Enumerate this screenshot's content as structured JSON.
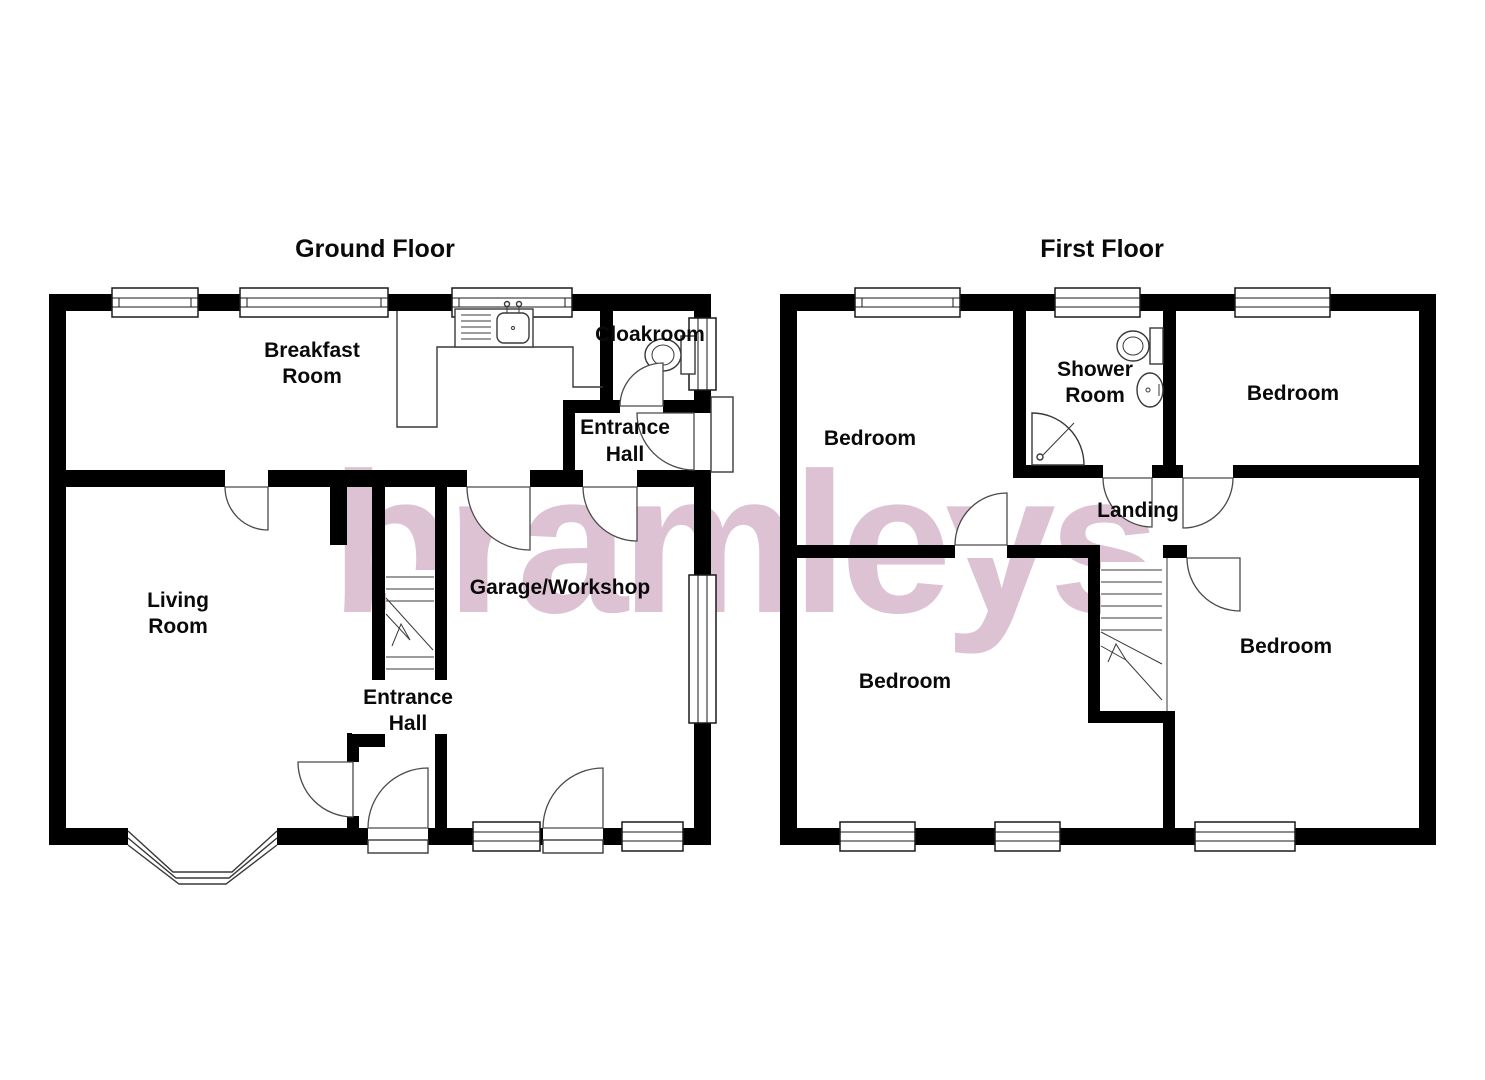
{
  "watermark": {
    "text": "bramleys",
    "color": "#ddc2d3"
  },
  "titles": {
    "ground": "Ground Floor",
    "first": "First Floor"
  },
  "ground_floor": {
    "breakfast_room": [
      "Breakfast",
      "Room"
    ],
    "cloakroom": [
      "Cloakroom"
    ],
    "entrance_hall_upper": [
      "Entrance",
      "Hall"
    ],
    "living_room": [
      "Living",
      "Room"
    ],
    "entrance_hall_lower": [
      "Entrance",
      "Hall"
    ],
    "garage": [
      "Garage/Workshop"
    ]
  },
  "first_floor": {
    "bedroom_top_left": [
      "Bedroom"
    ],
    "shower_room": [
      "Shower",
      "Room"
    ],
    "bedroom_top_right": [
      "Bedroom"
    ],
    "landing": [
      "Landing"
    ],
    "bedroom_bottom_left": [
      "Bedroom"
    ],
    "bedroom_bottom_right": [
      "Bedroom"
    ]
  }
}
